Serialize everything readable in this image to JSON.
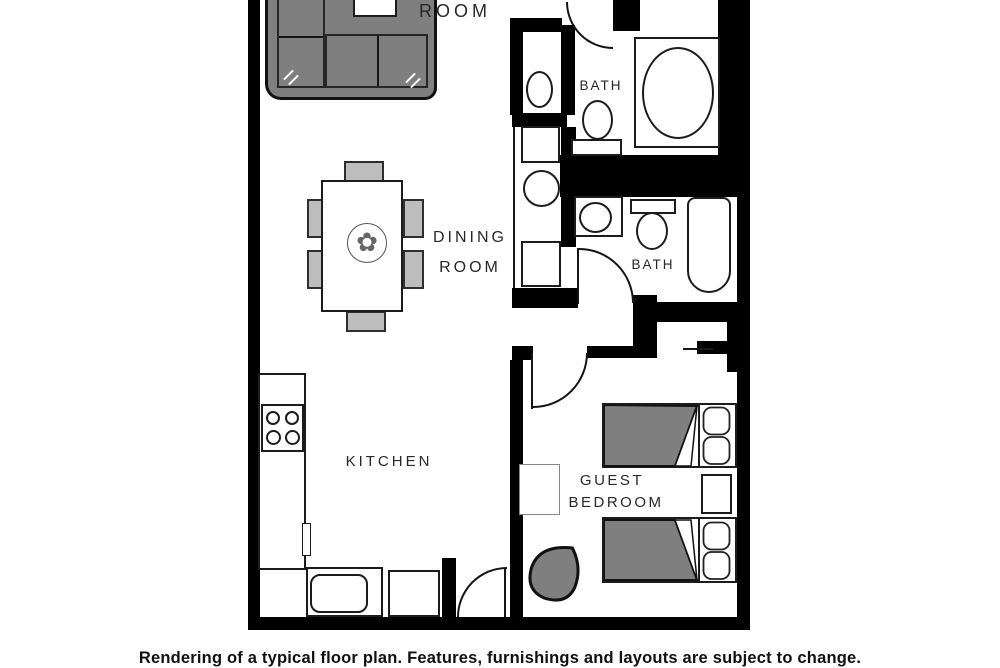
{
  "floor_plan": {
    "rooms": {
      "living_room_label": "ROOM",
      "dining_room_label_line1": "DINING",
      "dining_room_label_line2": "ROOM",
      "kitchen_label": "KITCHEN",
      "bath_top_label": "BATH",
      "bath_middle_label": "BATH",
      "guest_bedroom_label_line1": "GUEST",
      "guest_bedroom_label_line2": "BEDROOM"
    },
    "caption": "Rendering of a typical floor plan. Features, furnishings and layouts are subject to change.",
    "icons": {
      "table_centerpiece": "✿"
    },
    "colors": {
      "wall": "#000000",
      "furniture": "#7f7f7f",
      "line": "#1a1a1a",
      "background": "#ffffff"
    }
  }
}
